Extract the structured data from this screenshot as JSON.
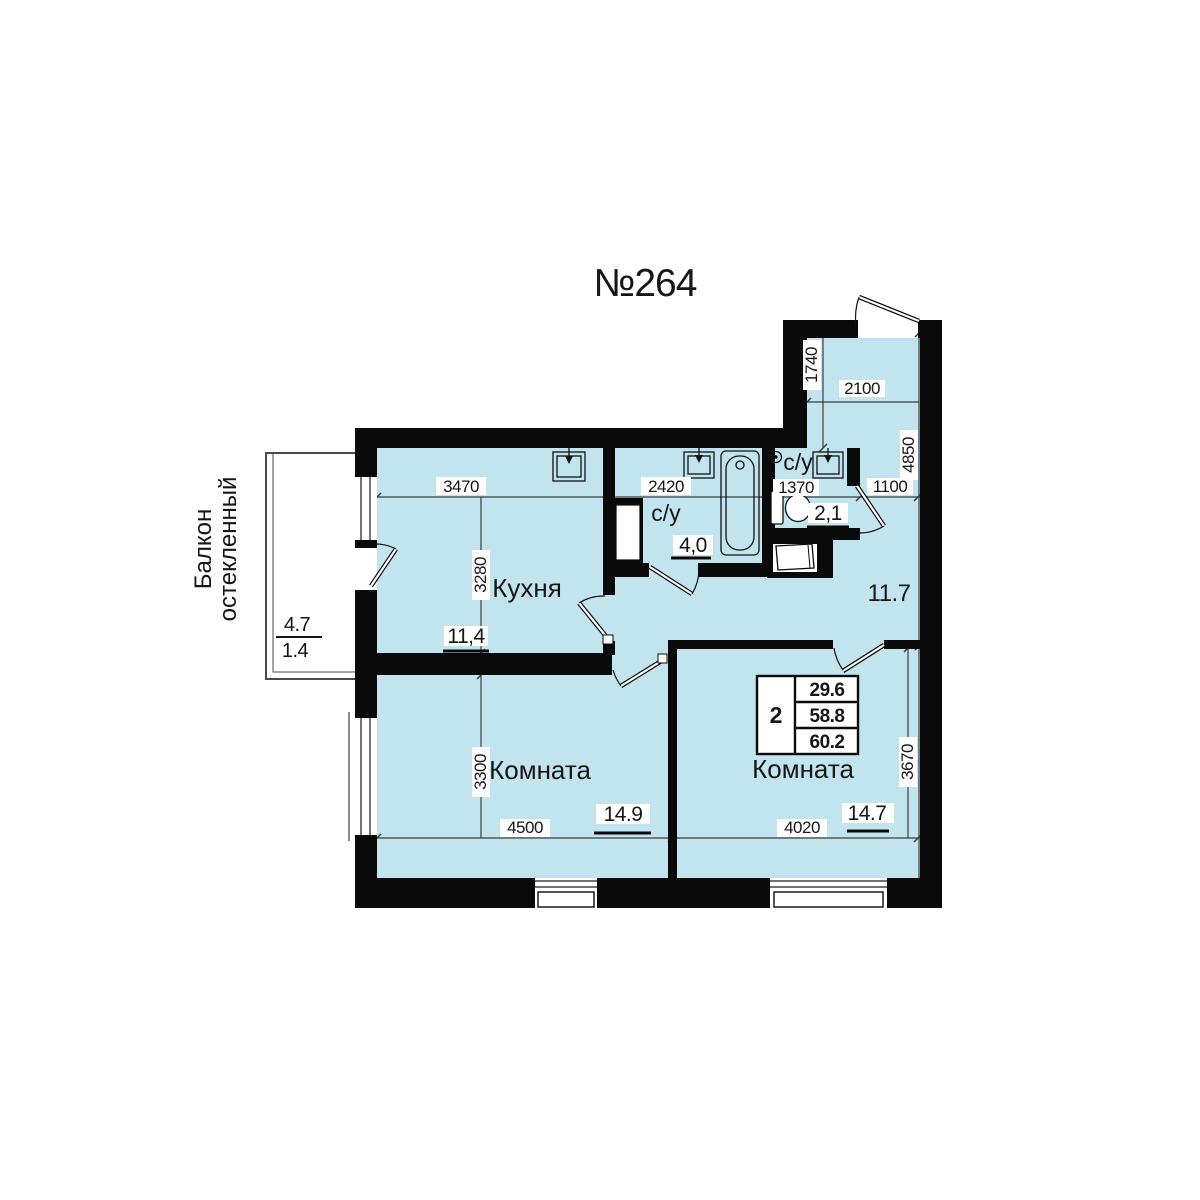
{
  "title": "№264",
  "colors": {
    "floor": "#c2e4ef",
    "wall": "#0a0a0a"
  },
  "balcony": {
    "name_line1": "Балкон",
    "name_line2": "остекленный",
    "area_full": "4.7",
    "area_reduced": "1.4"
  },
  "rooms": {
    "kitchen": {
      "name": "Кухня",
      "area": "11,4",
      "width_mm": "3470",
      "depth_mm": "3280"
    },
    "bathroom": {
      "name": "с/у",
      "area": "4,0",
      "width_mm": "2420"
    },
    "wc": {
      "name": "с/у",
      "area": "2,1",
      "width_mm": "1370"
    },
    "hallway": {
      "area": "11.7",
      "width_mm": "1100",
      "depth_mm": "4850"
    },
    "entry": {
      "width_mm": "2100",
      "depth_mm": "1740"
    },
    "room_left": {
      "name": "Комната",
      "area": "14.9",
      "width_mm": "4500",
      "depth_mm": "3300"
    },
    "room_right": {
      "name": "Комната",
      "area": "14.7",
      "width_mm": "4020",
      "depth_mm": "3670"
    }
  },
  "info_table": {
    "rooms_count": "2",
    "rows": [
      "29.6",
      "58.8",
      "60.2"
    ]
  }
}
